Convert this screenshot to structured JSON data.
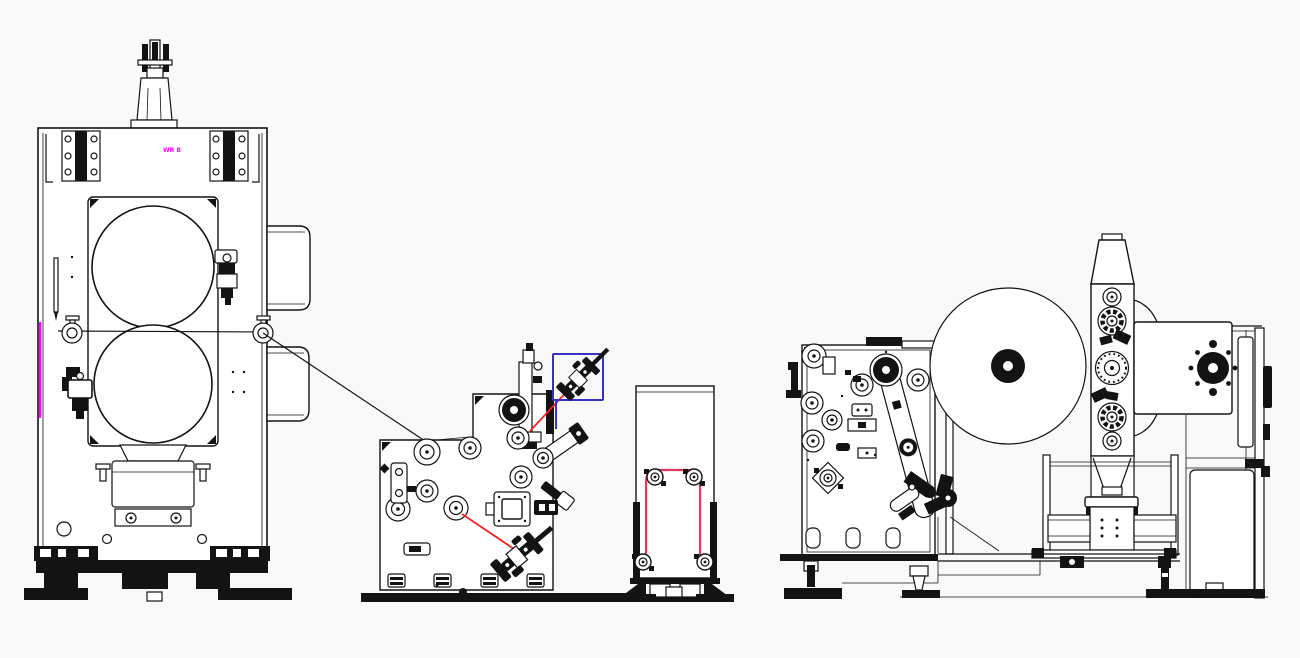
{
  "page": {
    "background": "#f9f9f9"
  },
  "colors": {
    "line": "#131313",
    "magenta": "#ff00ff",
    "red": "#ff2020",
    "web_red": "#e8365d",
    "blue": "#3434c4"
  },
  "labels": {
    "press_plate_label": "WR B"
  }
}
